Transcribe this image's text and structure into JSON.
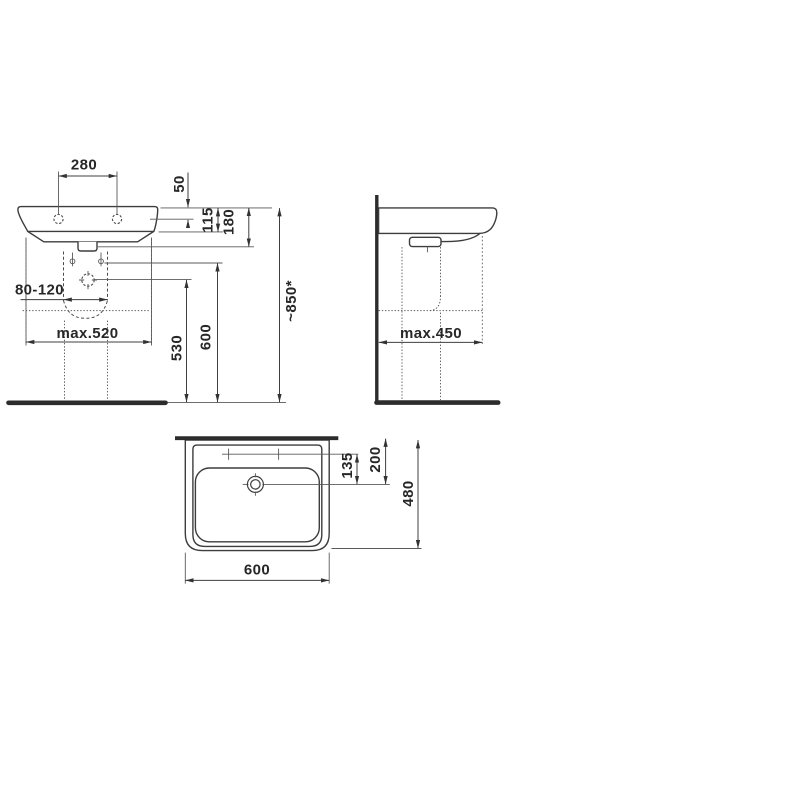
{
  "colors": {
    "background": "#ffffff",
    "line": "#3d3d3d",
    "text": "#272727"
  },
  "dims": {
    "tap_spacing": "280",
    "rim_to_tap_hole": "50",
    "rim_to_underside": "115",
    "basin_body_height": "180",
    "drain_range": "80-120",
    "max_width": "max.520",
    "drain_center_height": "530",
    "fixing_holes_height": "600",
    "rim_height": "~850*",
    "max_depth": "max.450",
    "tap_holes_to_center": "135",
    "wall_to_tap_center": "200",
    "basin_depth": "480",
    "basin_width": "600"
  }
}
